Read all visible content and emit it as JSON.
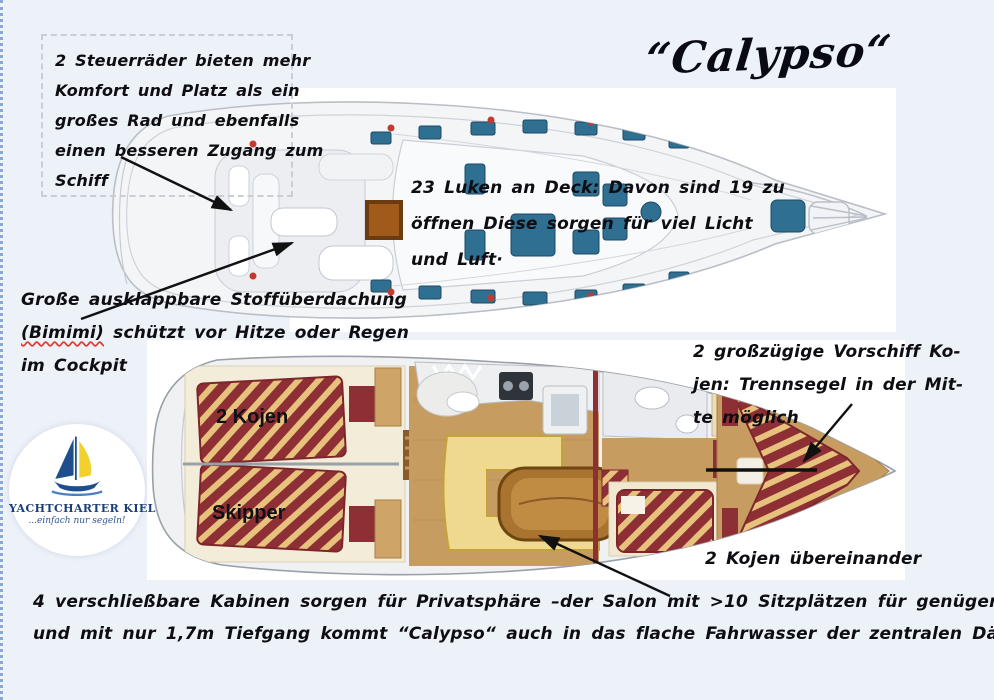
{
  "title": "“Calypso“",
  "notes": {
    "steering": {
      "lines": [
        "2 Steuerräder bieten mehr",
        "Komfort und Platz als ein",
        "großes Rad und ebenfalls",
        "einen besseren Zugang zum",
        "Schiff"
      ]
    },
    "hatches": {
      "lines": [
        "23 Luken an Deck: Davon sind 19 zu",
        "öffnen Diese sorgen für viel Licht",
        "und Luft·"
      ]
    },
    "bimini": {
      "line1": "Große ausklappbare Stoffüberdachung",
      "highlight": "(Bimimi)",
      "line2_rest": " schützt vor Hitze oder Regen",
      "line3": "im Cockpit"
    },
    "foreship": {
      "lines": [
        "2 großzügige Vorschiff Ko-",
        "jen: Trennsegel in der Mit-",
        "te möglich"
      ]
    },
    "bunks": "2 Kojen übereinander"
  },
  "cabin_labels": {
    "aft_port": "2 Kojen",
    "aft_starboard": "Skipper"
  },
  "footer": {
    "lines": [
      "4 verschließbare Kabinen sorgen für Privatsphäre –der Salon mit >10 Sitzplätzen für genügend Platz",
      "und mit nur 1,7m Tiefgang kommt “Calypso“ auch in das flache Fahrwasser der zentralen Dän· Südsee·"
    ]
  },
  "logo": {
    "name": "YACHTCHARTER KIEL",
    "tagline": "...einfach nur segeln!",
    "icon": "sailboat-icon"
  },
  "colors": {
    "background": "#edf1f8",
    "ink": "#0d0d12",
    "hatch_blue": "#2f6f92",
    "bed_red": "#8e2f35",
    "stripe_tan": "#e7c27c",
    "wood": "#c79c60",
    "sofa_yellow": "#efd98e",
    "logo_navy": "#1c3e74",
    "logo_yellow": "#f2d12e",
    "arrow": "#111111",
    "spellcheck_red": "#e03a2f"
  }
}
